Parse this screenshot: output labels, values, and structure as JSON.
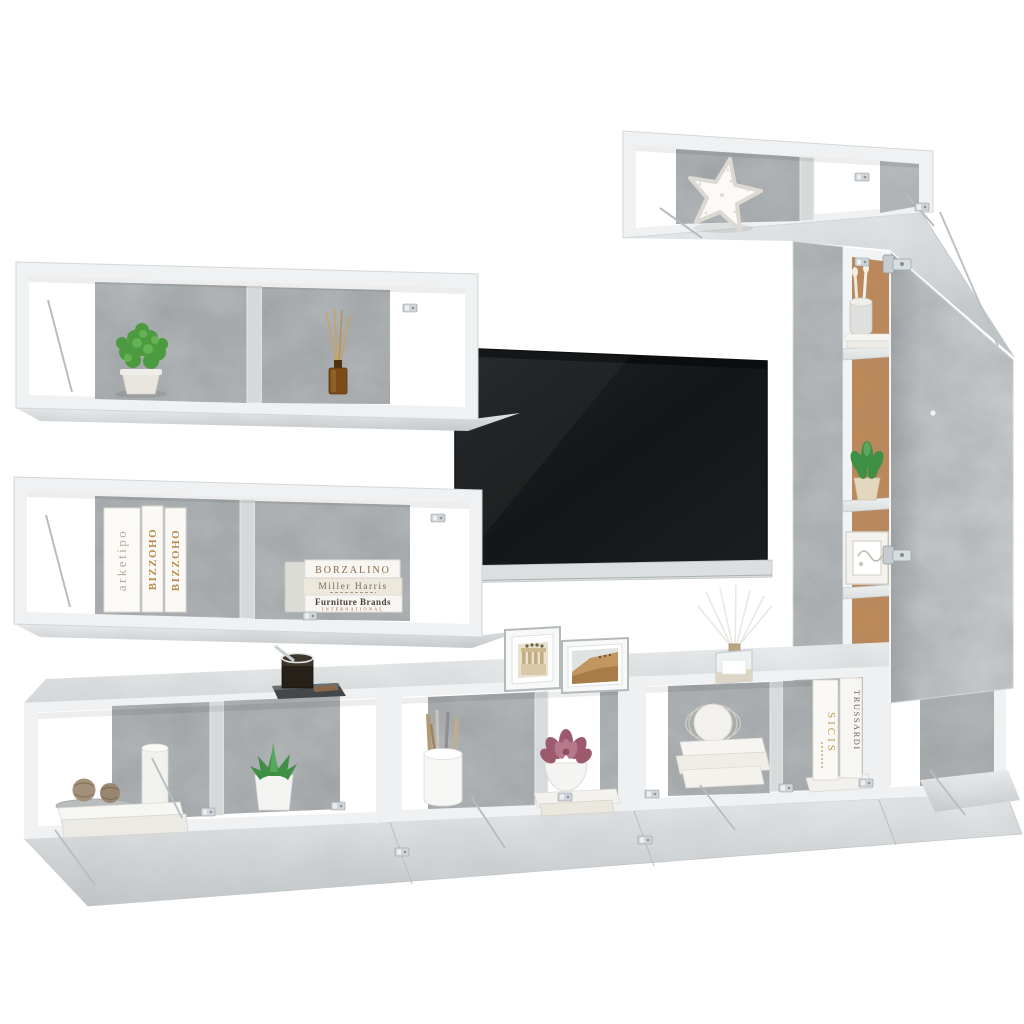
{
  "meta": {
    "type": "product-photo",
    "subject": "Wall-mounted modular TV entertainment wall unit in concrete grey with decor props and flat-screen TV",
    "background": "#ffffff"
  },
  "palette": {
    "concrete": "#b5b9bb",
    "concrete_light": "#d6d9da",
    "surface_light": "#e7e9ea",
    "edge_white": "#f0f2f3",
    "back_panel_brown": "#bf8a58",
    "tv_screen": "#17191b",
    "tv_rail": "#dcdfe0",
    "metal": "#ccd1d5",
    "plant_green": "#4f9c42",
    "succulent_pink": "#a86478",
    "amber_glass": "#7b4b18",
    "twine_tan": "#a08c71"
  },
  "books": {
    "shelf_vertical": [
      {
        "title": "arketipo"
      },
      {
        "title": "BIZZOHO"
      },
      {
        "title": "BIZZOHO"
      }
    ],
    "shelf_stack": [
      {
        "title": "BORZALINO"
      },
      {
        "title": "Miller Harris"
      },
      {
        "title": "Furniture Brands"
      }
    ],
    "stack_subtitle": "INTERNATIONAL",
    "cabinet_vertical": [
      {
        "title": "SICIS"
      },
      {
        "title": "TRUSSARDI"
      }
    ]
  }
}
